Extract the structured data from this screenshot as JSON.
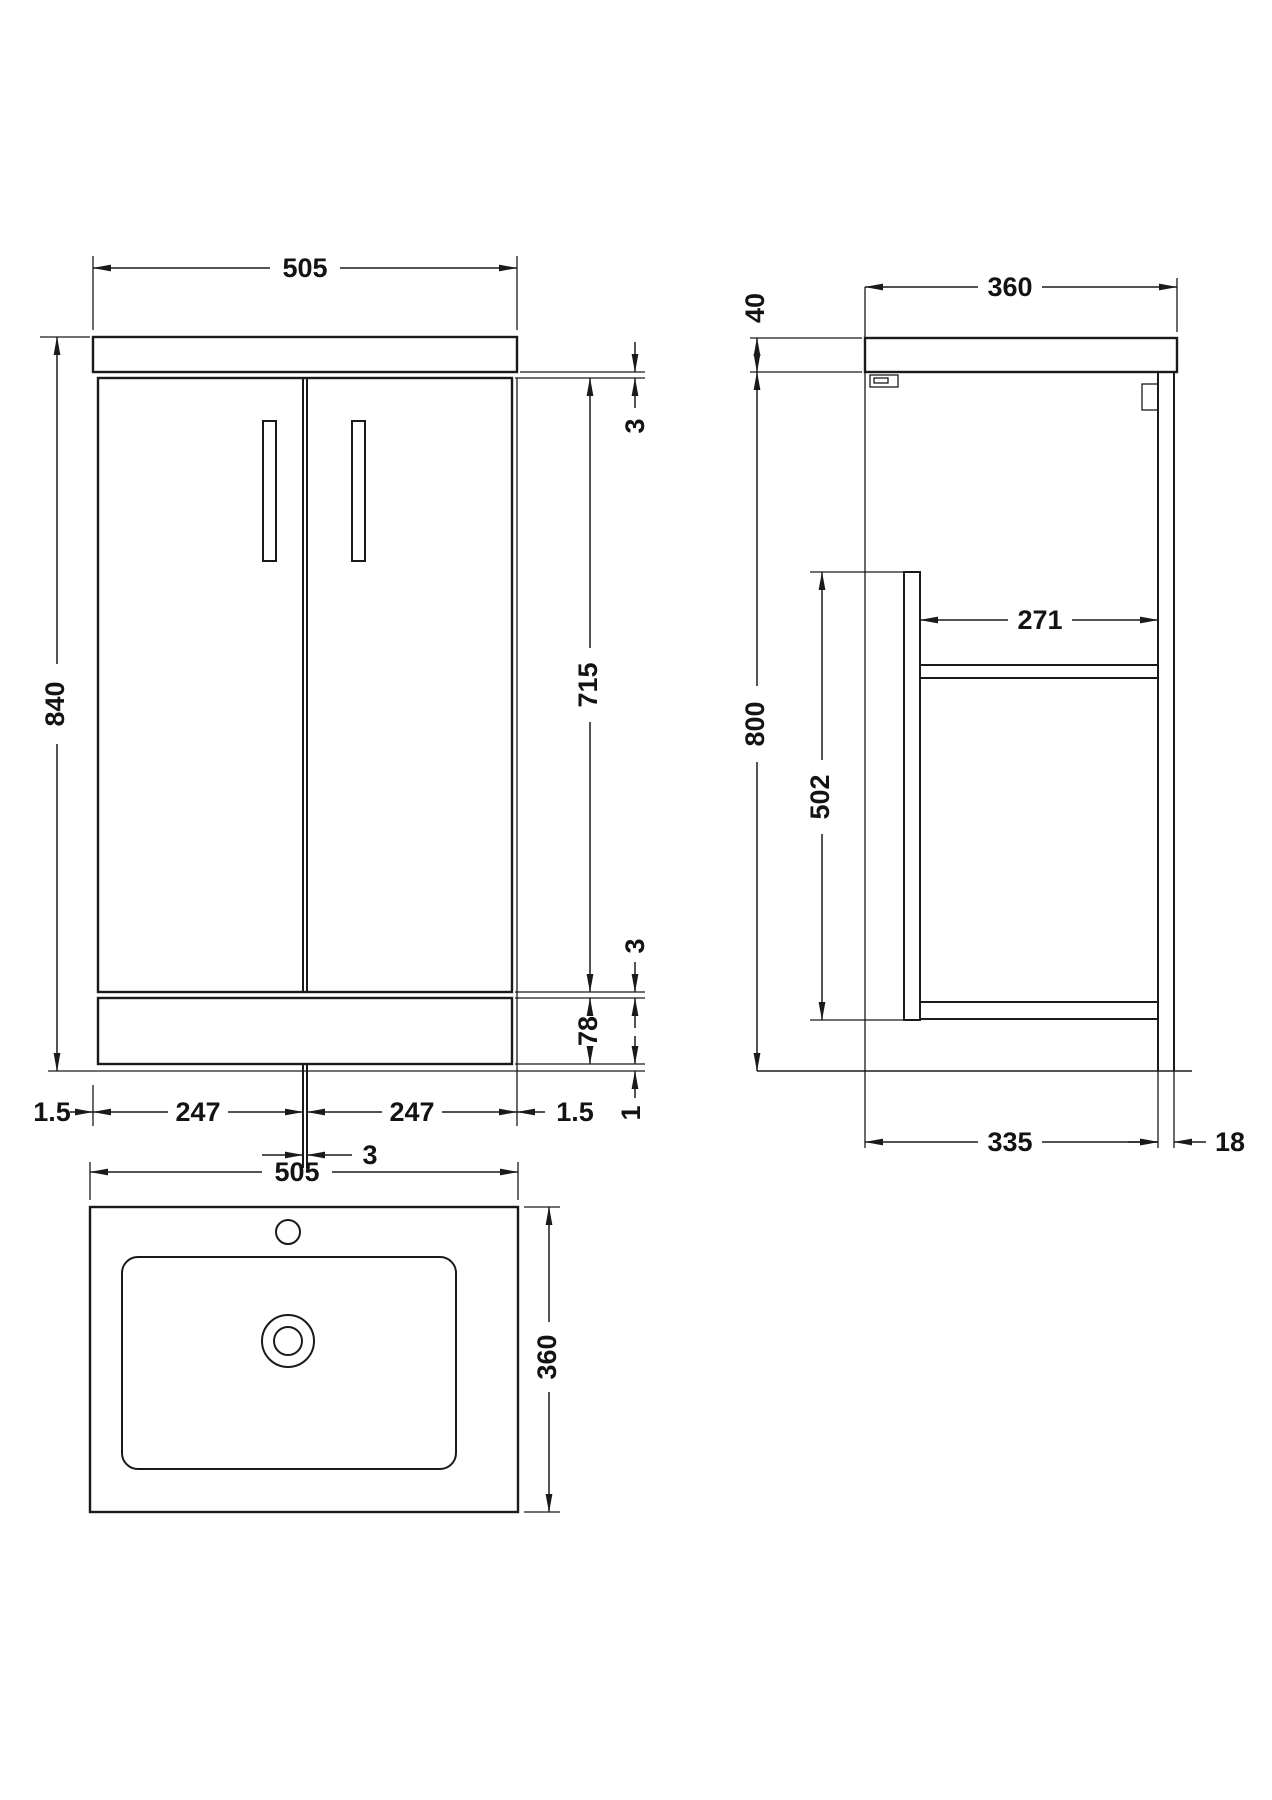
{
  "views": {
    "front": {
      "counter_width": "505",
      "overall_height": "840",
      "top_gap": "3",
      "door_height": "715",
      "bottom_gap": "3",
      "plinth_height": "78",
      "left_overhang": "1.5",
      "left_door_width": "247",
      "right_door_width": "247",
      "right_overhang": "1.5",
      "floor_gap": "1",
      "center_gap": "3"
    },
    "side": {
      "counter_thickness": "40",
      "counter_depth": "360",
      "carcass_height": "800",
      "panel_height": "502",
      "internal_depth": "271",
      "base_depth": "335",
      "back_panel_thickness": "18"
    },
    "plan": {
      "basin_width": "505",
      "basin_depth": "360"
    }
  },
  "colors": {
    "line": "#1a1a1a",
    "background": "#ffffff"
  }
}
